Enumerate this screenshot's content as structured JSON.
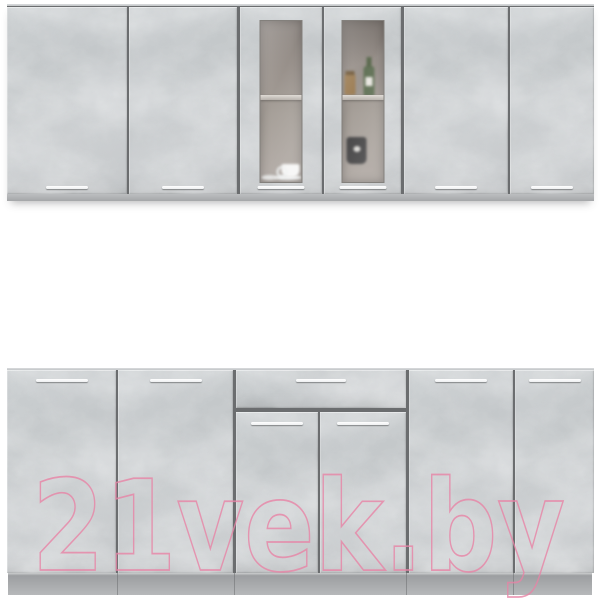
{
  "watermark": {
    "text": "21vek.by",
    "color": "#e884a6"
  },
  "scene": {
    "label": "Kitchen cabinet set, concrete-gray facades on white background",
    "background_color": "#ffffff",
    "upper_row": {
      "sections": [
        {
          "name": "left wall cabinet",
          "doors": 2,
          "front": "solid"
        },
        {
          "name": "center wall cabinet",
          "doors": 2,
          "front": "frosted glass"
        },
        {
          "name": "right wall cabinet",
          "doors": 2,
          "front": "solid"
        }
      ],
      "glass_contents": [
        "white cup with saucer",
        "small plate",
        "green bottle",
        "amber jar",
        "dark mug"
      ]
    },
    "lower_row": {
      "sections": [
        {
          "name": "left base cabinet",
          "doors": 2,
          "drawers": 0
        },
        {
          "name": "center base cabinet",
          "doors": 2,
          "drawers": 1
        },
        {
          "name": "right base cabinet",
          "doors": 2,
          "drawers": 0
        }
      ]
    },
    "colors": {
      "facade": "#c7cacc",
      "divider": "#6b6d6f",
      "carcass_strip": "#b0b2b4",
      "plinth": "#aaacae",
      "handle": "#ffffff",
      "glass_pane": "#a29a94",
      "glass_shelf": "#d5cfc9"
    }
  }
}
